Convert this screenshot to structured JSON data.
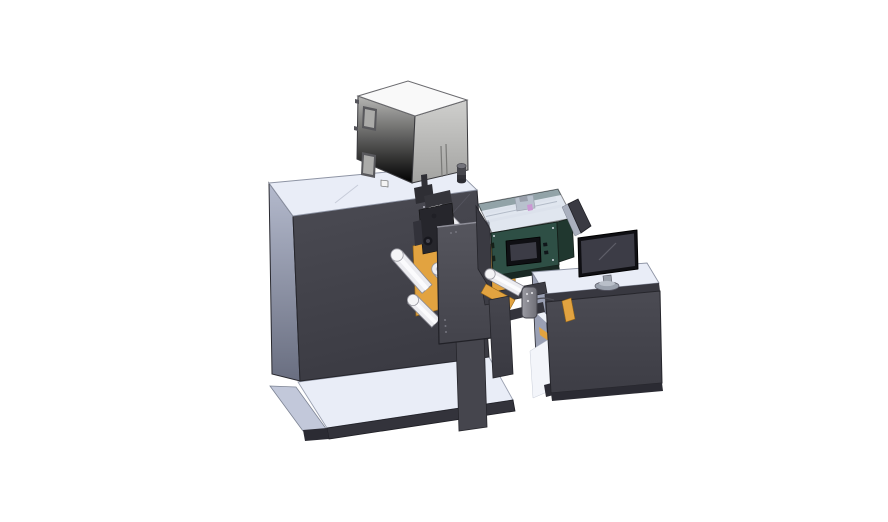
{
  "scene": {
    "title": "CAD render of roll-fed printing machine with operator desk",
    "view": "isometric 3D render, white background",
    "objects": [
      {
        "id": "base-platform",
        "label": "Floor base platform of machine"
      },
      {
        "id": "main-cabinet",
        "label": "Main machine cabinet (charcoal)"
      },
      {
        "id": "top-enclosure",
        "label": "Electrical enclosure box on cabinet top"
      },
      {
        "id": "print-mechanism",
        "label": "Web path: orange plates, guide rollers, print head"
      },
      {
        "id": "front-cover-plate",
        "label": "Dark front cover plate"
      },
      {
        "id": "marking-unit",
        "label": "Teal marking unit with small display and clear cover"
      },
      {
        "id": "bridge-conveyor",
        "label": "Bridge conveyor between machine and desk"
      },
      {
        "id": "pendant-control",
        "label": "Hanging pendant control"
      },
      {
        "id": "operator-desk",
        "label": "Operator desk cabinet"
      },
      {
        "id": "rear-panel",
        "label": "Rear display panel seen edge-on"
      },
      {
        "id": "monitor",
        "label": "Desktop monitor on stand"
      }
    ]
  },
  "palette": {
    "background": "#ffffff",
    "top_light": "#e9edf7",
    "body_dark": "#45454d",
    "body_darker": "#33333b",
    "side_light": "#c2c8da",
    "desk_side": "#9aa0b4",
    "outline": "#26262c",
    "box_top": "#f9f9f9",
    "orange": "#e2a340",
    "orange_dark": "#d89a33",
    "roller_white": "#ececf0",
    "teal_front": "#2e4f45",
    "teal_dark": "#20372f",
    "display_black": "#0f0f13",
    "screen_gray": "#3c3c46",
    "metal_gray": "#9aa0aa",
    "magenta": "#c838b8",
    "glass": "#cdd7e5"
  }
}
